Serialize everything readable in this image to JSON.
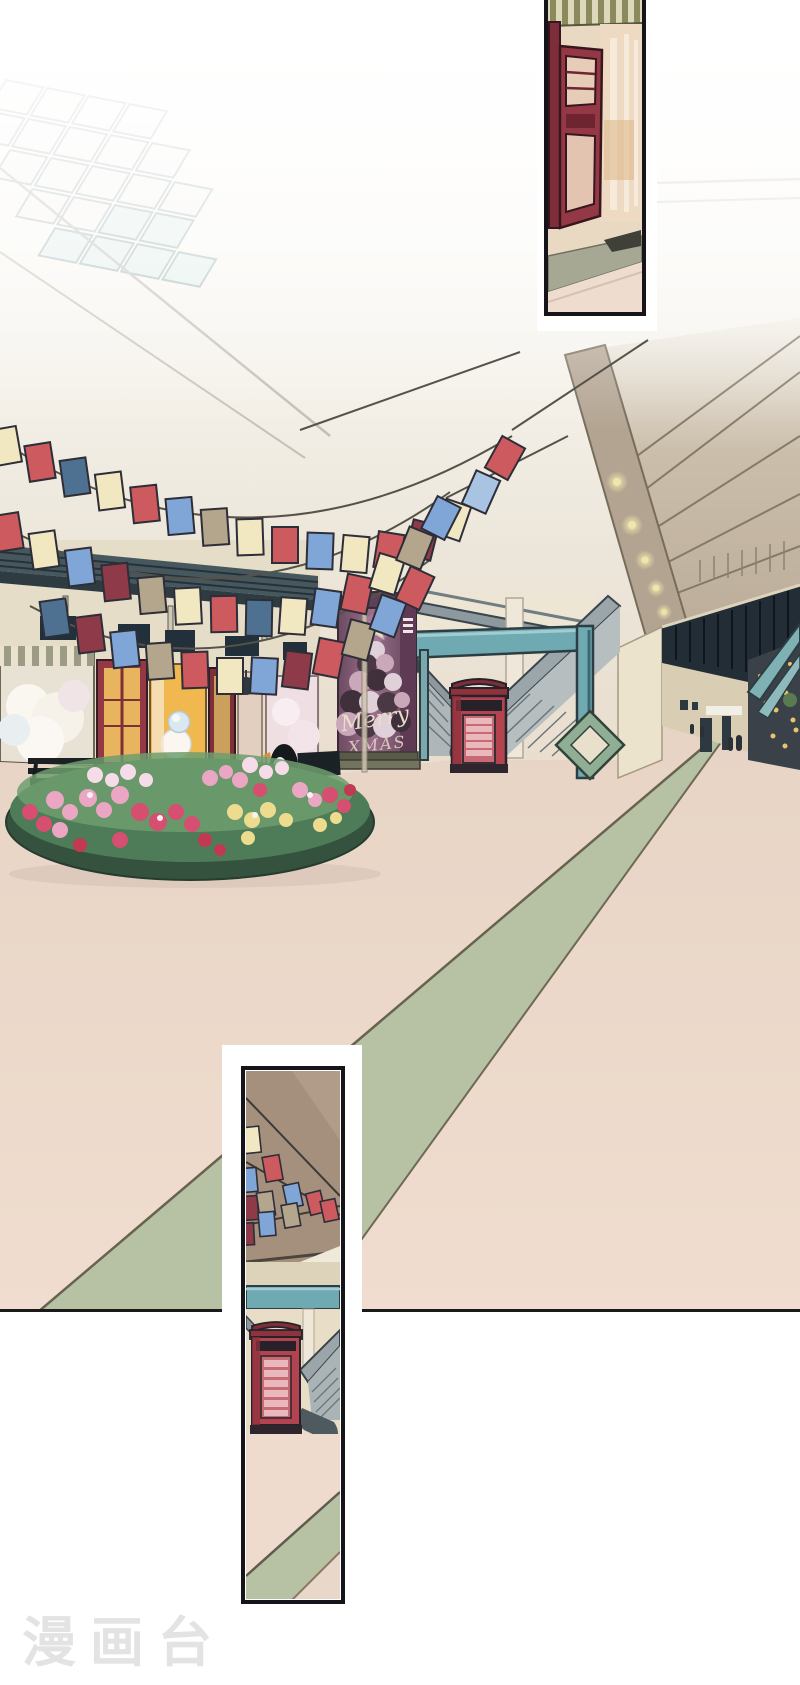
{
  "page": {
    "width": 800,
    "height": 1685,
    "background": "#ffffff"
  },
  "watermark": {
    "text": "漫画台"
  },
  "main_panel": {
    "scene": "mall-atrium-with-christmas-decorations",
    "poster": {
      "line1": "Merry",
      "line2": "XMAS"
    },
    "storefront_letters": {
      "left": "R",
      "right": "B"
    }
  },
  "palette": {
    "flag_cream": "#f1e8c2",
    "flag_red": "#cd5a5e",
    "flag_blue": "#7fa6d6",
    "flag_lightblue": "#a9c3e2",
    "flag_slate": "#4e7191",
    "flag_maroon": "#8e3a49",
    "flag_tan": "#b3a68c",
    "floor_pink": "#ecdacb",
    "carpet_green": "#b7c1a3",
    "ceiling_tan": "#c4b7a4",
    "corridor_dark": "#232d35",
    "beam_teal": "#6fa9b2",
    "booth_red": "#b2434f",
    "pillar_purple": "#8a5f7d",
    "foliage_green": "#4e7c58",
    "flower_pink": "#eba6c3",
    "flower_deeppink": "#d64e70",
    "flower_yellow": "#eedc8e",
    "flower_pale": "#f6dce8",
    "door_maroon": "#953845",
    "wall_cream": "#e8ddc6",
    "escalator_gray": "#9aa6aa",
    "frame_line": "#14141a",
    "watermark_gray": "#e3e3e3"
  }
}
